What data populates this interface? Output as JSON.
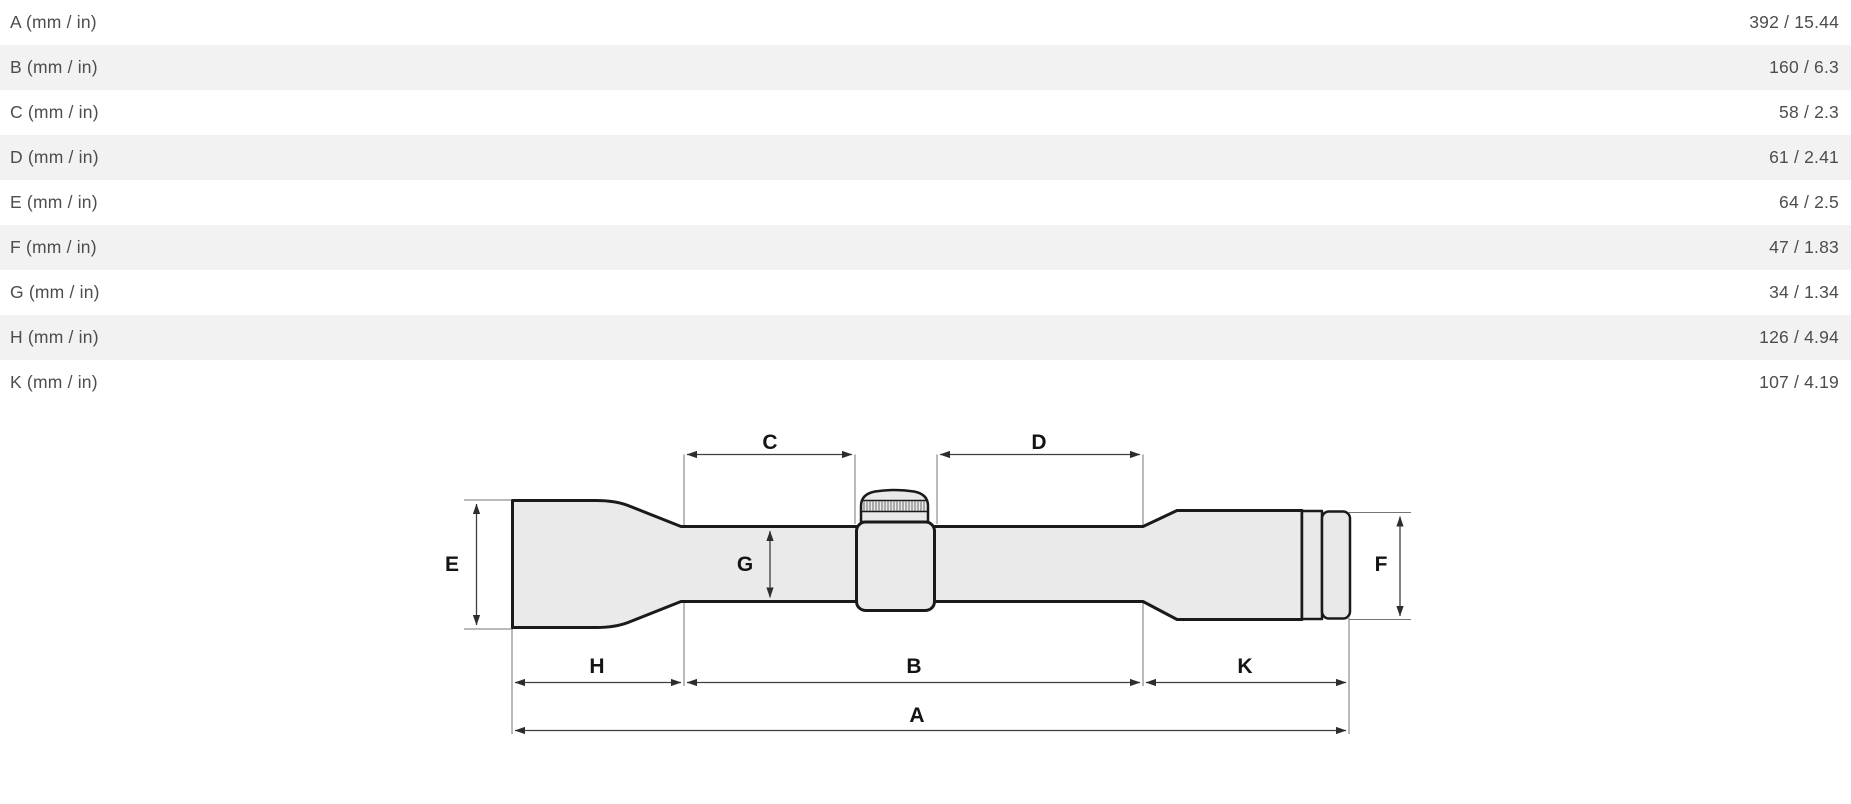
{
  "table": {
    "rows": [
      {
        "label": "A (mm / in)",
        "value": "392 / 15.44"
      },
      {
        "label": "B (mm / in)",
        "value": "160 / 6.3"
      },
      {
        "label": "C (mm / in)",
        "value": "58 / 2.3"
      },
      {
        "label": "D (mm / in)",
        "value": "61 / 2.41"
      },
      {
        "label": "E (mm / in)",
        "value": "64 / 2.5"
      },
      {
        "label": "F (mm / in)",
        "value": "47 / 1.83"
      },
      {
        "label": "G (mm / in)",
        "value": "34 / 1.34"
      },
      {
        "label": "H (mm / in)",
        "value": "126 / 4.94"
      },
      {
        "label": "K (mm / in)",
        "value": "107 / 4.19"
      }
    ],
    "colors": {
      "row_alt": "#f2f2f2",
      "row_bg": "#ffffff",
      "text": "#4d4d4d"
    }
  },
  "diagram": {
    "labels": {
      "a": "A",
      "b": "B",
      "c": "C",
      "d": "D",
      "e": "E",
      "f": "F",
      "g": "G",
      "h": "H",
      "k": "K"
    },
    "colors": {
      "scope_fill": "#eaeaea",
      "outline": "#1a1a1a",
      "dimension_line": "#3f3f3f",
      "label_text": "#141414"
    }
  }
}
